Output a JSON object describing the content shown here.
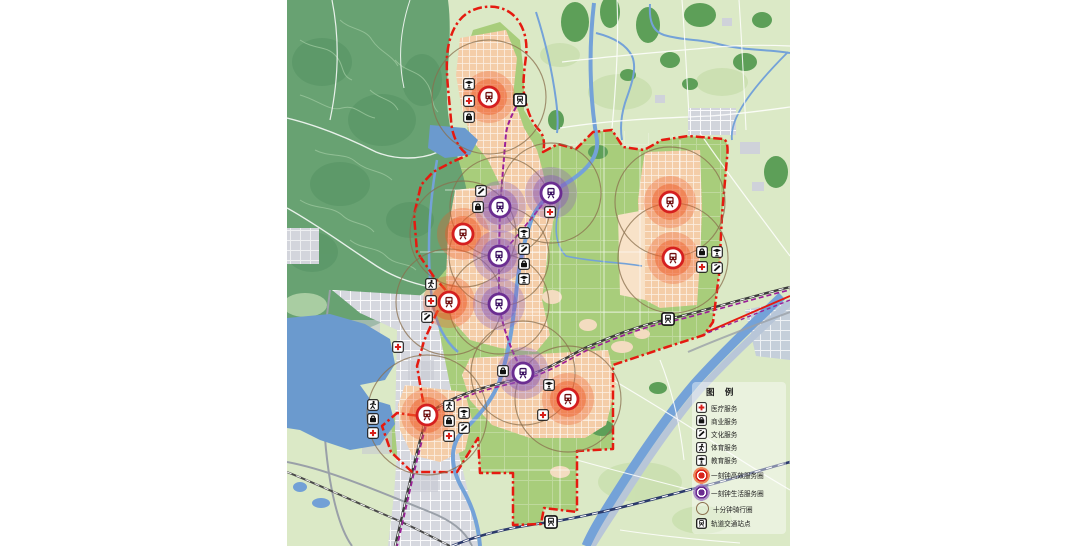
{
  "map": {
    "legend": {
      "title": "图 例",
      "items": [
        {
          "id": "medical",
          "label": "医疗服务",
          "icon": "medical-cross-icon"
        },
        {
          "id": "commercial",
          "label": "商业服务",
          "icon": "shopping-bag-icon"
        },
        {
          "id": "cultural",
          "label": "文化服务",
          "icon": "culture-icon"
        },
        {
          "id": "sports",
          "label": "体育服务",
          "icon": "sports-icon"
        },
        {
          "id": "education",
          "label": "教育服务",
          "icon": "education-icon"
        },
        {
          "id": "efficient-circle",
          "label": "一刻钟高效服务圈",
          "icon": "red-service-circle"
        },
        {
          "id": "life-circle",
          "label": "一刻钟生活服务圈",
          "icon": "purple-service-circle"
        },
        {
          "id": "cycling-circle",
          "label": "十分钟骑行圈",
          "icon": "cycling-ring"
        },
        {
          "id": "rail-station",
          "label": "轨道交通站点",
          "icon": "train-station-icon"
        }
      ]
    },
    "colors": {
      "boundary_red": "#e51a10",
      "efficient_ring": "#d51f1f",
      "efficient_halo": "#ee5a28",
      "life_ring": "#6b2d91",
      "life_halo": "#8a5cb8",
      "cycling_ring": "#8a6f4d",
      "metro_line": "#9b1f97",
      "railway_navy": "#2b3a6b",
      "water": "#74a2d8",
      "parkland_green": "#a8cd7b",
      "built_peach": "#f4cda8",
      "urban_gray": "#d6d8df",
      "mountain_green": "#68a272"
    },
    "markers": [
      {
        "type": "efficient",
        "x": 489,
        "y": 97,
        "ride_r": 57
      },
      {
        "type": "efficient",
        "x": 463,
        "y": 234,
        "ride_r": 53
      },
      {
        "type": "efficient",
        "x": 449,
        "y": 302,
        "ride_r": 53
      },
      {
        "type": "efficient",
        "x": 427,
        "y": 415,
        "ride_r": 60
      },
      {
        "type": "efficient",
        "x": 568,
        "y": 399,
        "ride_r": 53
      },
      {
        "type": "efficient",
        "x": 670,
        "y": 202,
        "ride_r": 55
      },
      {
        "type": "efficient",
        "x": 673,
        "y": 258,
        "ride_r": 55
      },
      {
        "type": "life",
        "x": 551,
        "y": 193,
        "ride_r": 50
      },
      {
        "type": "life",
        "x": 500,
        "y": 207,
        "ride_r": 50
      },
      {
        "type": "life",
        "x": 499,
        "y": 256,
        "ride_r": 50
      },
      {
        "type": "life",
        "x": 499,
        "y": 304,
        "ride_r": 50
      },
      {
        "type": "life",
        "x": 523,
        "y": 373,
        "ride_r": 52
      }
    ],
    "service_icons": [
      {
        "type": "education",
        "x": 469,
        "y": 84
      },
      {
        "type": "medical",
        "x": 469,
        "y": 101
      },
      {
        "type": "commercial",
        "x": 469,
        "y": 117
      },
      {
        "type": "cultural",
        "x": 481,
        "y": 191
      },
      {
        "type": "commercial",
        "x": 478,
        "y": 207
      },
      {
        "type": "medical",
        "x": 550,
        "y": 212
      },
      {
        "type": "education",
        "x": 524,
        "y": 233
      },
      {
        "type": "cultural",
        "x": 524,
        "y": 249
      },
      {
        "type": "commercial",
        "x": 524,
        "y": 264
      },
      {
        "type": "education",
        "x": 524,
        "y": 279
      },
      {
        "type": "sports",
        "x": 431,
        "y": 284
      },
      {
        "type": "medical",
        "x": 431,
        "y": 301
      },
      {
        "type": "cultural",
        "x": 427,
        "y": 317
      },
      {
        "type": "medical",
        "x": 398,
        "y": 347
      },
      {
        "type": "sports",
        "x": 373,
        "y": 405
      },
      {
        "type": "commercial",
        "x": 373,
        "y": 419
      },
      {
        "type": "medical",
        "x": 373,
        "y": 433
      },
      {
        "type": "sports",
        "x": 449,
        "y": 406
      },
      {
        "type": "commercial",
        "x": 449,
        "y": 421
      },
      {
        "type": "medical",
        "x": 449,
        "y": 436
      },
      {
        "type": "education",
        "x": 464,
        "y": 413
      },
      {
        "type": "cultural",
        "x": 464,
        "y": 428
      },
      {
        "type": "commercial",
        "x": 503,
        "y": 371
      },
      {
        "type": "education",
        "x": 549,
        "y": 385
      },
      {
        "type": "medical",
        "x": 543,
        "y": 415
      },
      {
        "type": "commercial",
        "x": 702,
        "y": 252
      },
      {
        "type": "education",
        "x": 717,
        "y": 252
      },
      {
        "type": "medical",
        "x": 702,
        "y": 267
      },
      {
        "type": "cultural",
        "x": 717,
        "y": 268
      }
    ],
    "stations": [
      {
        "x": 520,
        "y": 100
      },
      {
        "x": 668,
        "y": 319
      },
      {
        "x": 551,
        "y": 522
      }
    ]
  }
}
